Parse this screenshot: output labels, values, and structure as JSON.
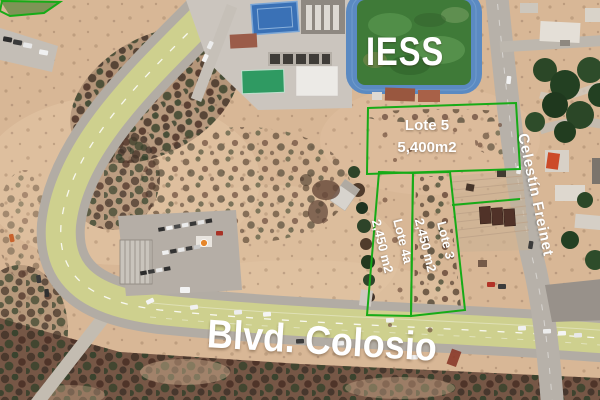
{
  "map": {
    "view_type": "satellite-aerial-lot-map",
    "field_label": "IESS",
    "street_label": "Celestín Freinet",
    "boulevard_label": "Blvd. Colosio",
    "lots": [
      {
        "name": "Lote 5",
        "area": "5,400m2"
      },
      {
        "name": "Lote 4a",
        "area": "2,450 m2"
      },
      {
        "name": "Lote 3",
        "area": "2,450 m2"
      }
    ],
    "colors": {
      "lot_boundary_green": "#17ab17",
      "label_text": "#ffffff",
      "sand": "#d8b796",
      "road_yellow": "#ced08e",
      "road_gray": "#b2aca4",
      "sports_field_green": "#3f7a38",
      "track_blue": "#5b8ac2",
      "court_blue": "#3a71b6"
    }
  }
}
